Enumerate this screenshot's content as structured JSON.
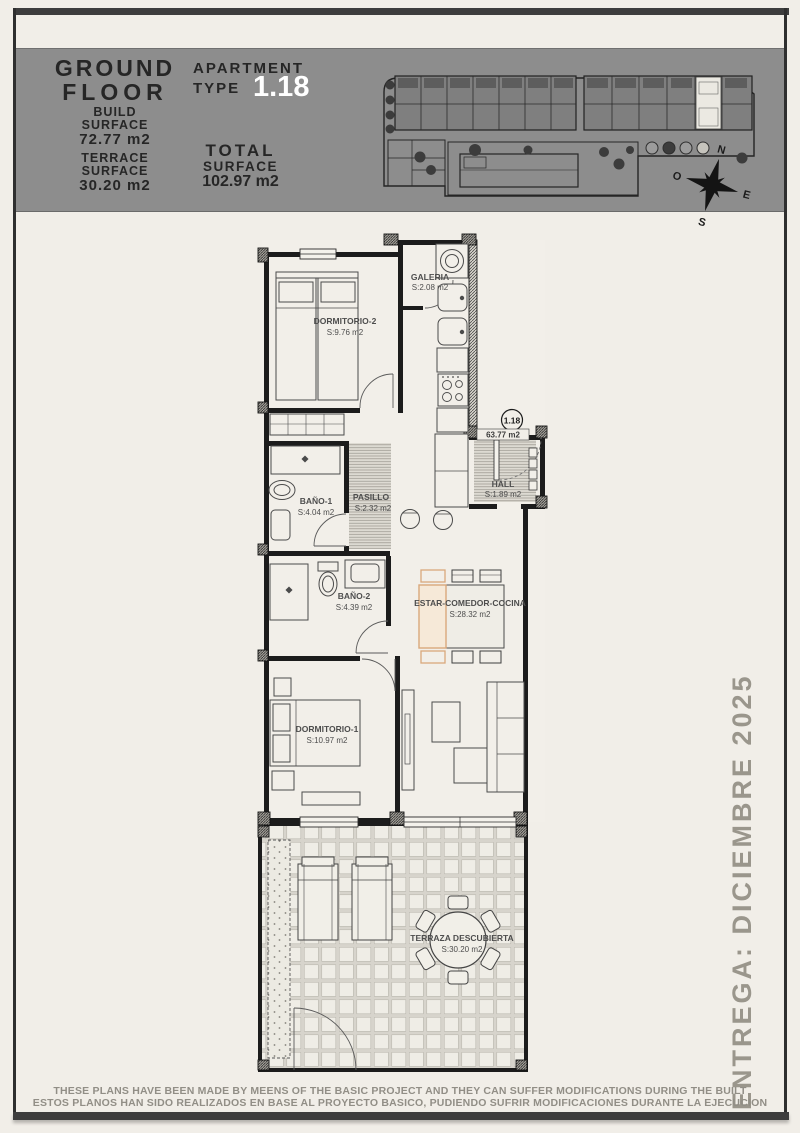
{
  "header": {
    "floor_line1": "GROUND",
    "floor_line2": "FLOOR",
    "apartment_label1": "APARTMENT",
    "apartment_label2": "TYPE",
    "apartment_number": "1.18",
    "build_label1": "BUILD",
    "build_label2": "SURFACE",
    "build_value": "72.77 m2",
    "terrace_label1": "TERRACE",
    "terrace_label2": "SURFACE",
    "terrace_value": "30.20 m2",
    "total_label1": "TOTAL",
    "total_label2": "SURFACE",
    "total_value": "102.97 m2"
  },
  "site_plan": {
    "compass": {
      "n": "N",
      "e": "E",
      "s": "S",
      "o": "O"
    }
  },
  "plan": {
    "badge": "1.18",
    "badge_area": "63.77 m2",
    "rooms": {
      "dorm2": {
        "name": "DORMITORIO-2",
        "area": "S:9.76 m2"
      },
      "galeria": {
        "name": "GALERIA",
        "area": "S:2.08 m2"
      },
      "bano1": {
        "name": "BAÑO-1",
        "area": "S:4.04 m2"
      },
      "pasillo": {
        "name": "PASILLO",
        "area": "S:2.32 m2"
      },
      "hall": {
        "name": "HALL",
        "area": "S:1.89 m2"
      },
      "bano2": {
        "name": "BAÑO-2",
        "area": "S:4.39 m2"
      },
      "estar": {
        "name": "ESTAR-COMEDOR-COCINA",
        "area": "S:28.32 m2"
      },
      "dorm1": {
        "name": "DORMITORIO-1",
        "area": "S:10.97 m2"
      },
      "terraza": {
        "name": "TERRAZA DESCUBIERTA",
        "area": "S:30.20 m2"
      }
    }
  },
  "side_note": "ENTREGA: DICIEMBRE 2025",
  "footer": {
    "line_en": "THESE PLANS HAVE BEEN MADE BY MEENS OF THE BASIC PROJECT AND THEY CAN SUFFER MODIFICATIONS DURING THE BUILT",
    "line_es": "ESTOS PLANOS HAN SIDO REALIZADOS EN BASE AL PROYECTO BASICO, PUDIENDO SUFRIR MODIFICACIONES DURANTE LA EJECUCION"
  },
  "colors": {
    "page": "#f1eee8",
    "band": "#8d8d8d",
    "accent": "#d9a87c",
    "ink": "#2a2a2a"
  }
}
